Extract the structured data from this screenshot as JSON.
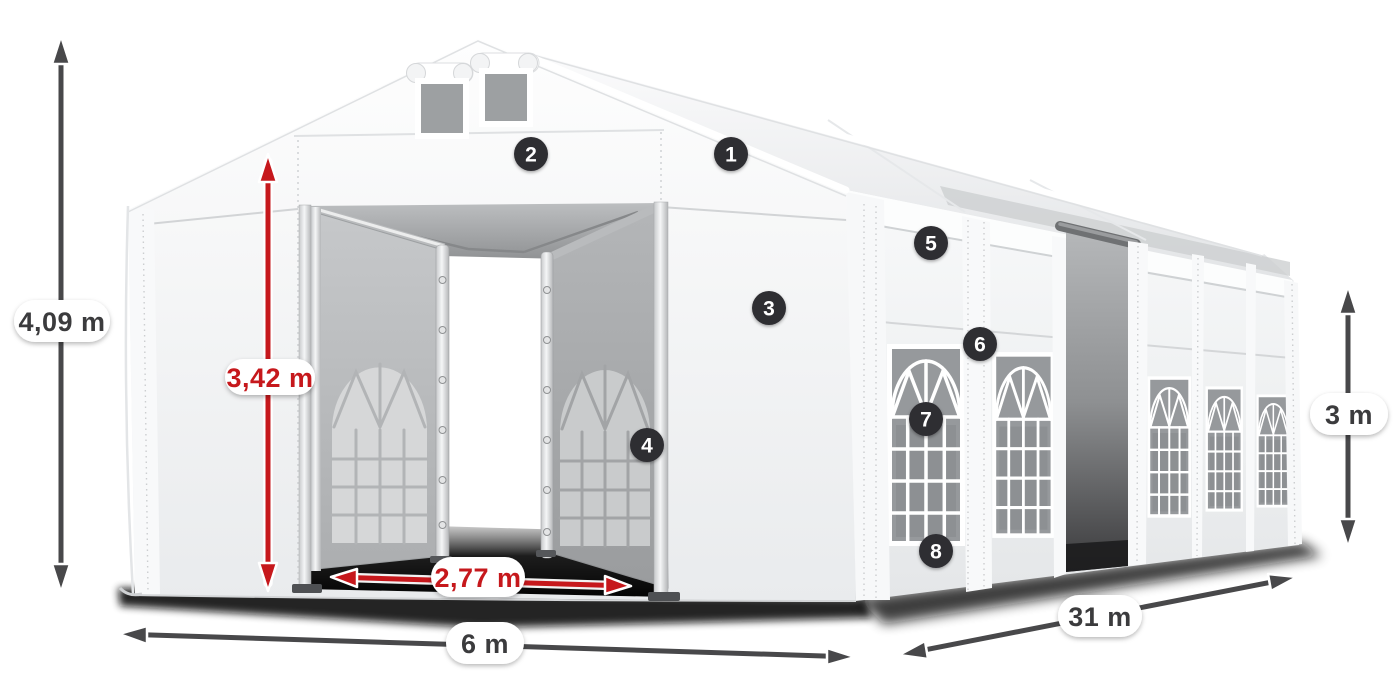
{
  "title": "Tent dimensions diagram",
  "dimensions": {
    "total_height": "4,09 m",
    "entrance_height": "3,42 m",
    "entrance_width": "2,77 m",
    "front_width": "6 m",
    "length": "31 m",
    "side_height": "3 m"
  },
  "callouts": [
    "1",
    "2",
    "3",
    "4",
    "5",
    "6",
    "7",
    "8"
  ],
  "colors": {
    "accent_red": "#c6181c",
    "arrow_dark": "#48484a",
    "badge_bg": "#2e2d33",
    "badge_text": "#ffffff",
    "pill_bg": "#ffffff",
    "label_dark": "#3b3b3d",
    "tent_white": "#ffffff",
    "tent_shade": "#e7e9eb",
    "glass_gray": "#96999c",
    "interior_dark": "#141414"
  }
}
